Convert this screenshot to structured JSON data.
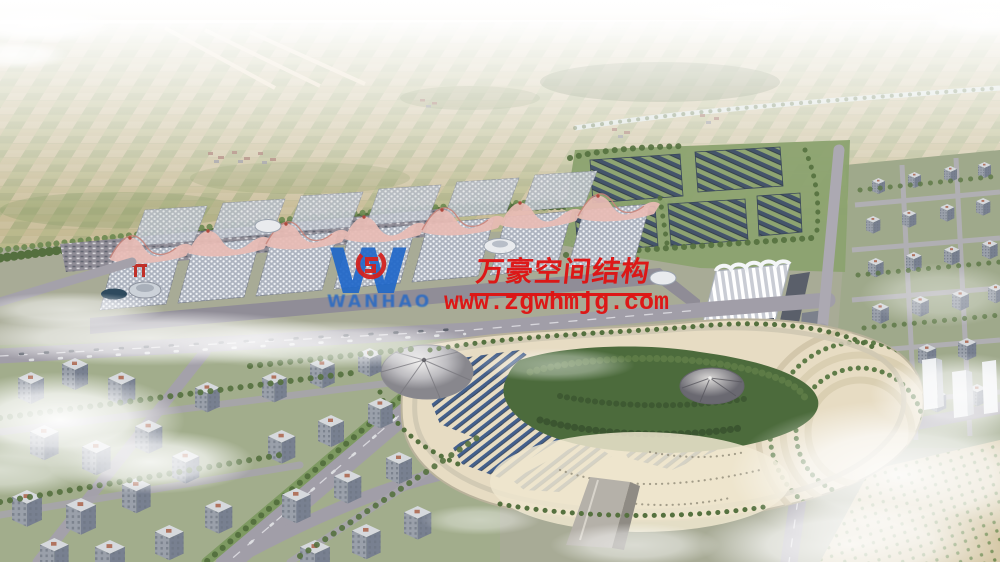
{
  "watermark": {
    "company_name": "万豪空间结构",
    "website": "www.zgwhmjg.com",
    "logo_text": "WANHAO",
    "logo_letter": "W",
    "accent_red": "#e01111",
    "logo_blue": "#1d66c9",
    "emblem_red": "#d3231f"
  },
  "scene": {
    "palette": {
      "sky_haze": "#f6f2e9",
      "farmland": "#cabd9a",
      "greenery": "#55713f",
      "roads": "#a19ea8",
      "hall_roof": "#aeb4c0",
      "hall_wave_pink": "#e9bcb5",
      "park_plaza": "#e7dcc3",
      "solar_panel": "#3c5a8a",
      "forest": "#4c6b3c"
    }
  }
}
